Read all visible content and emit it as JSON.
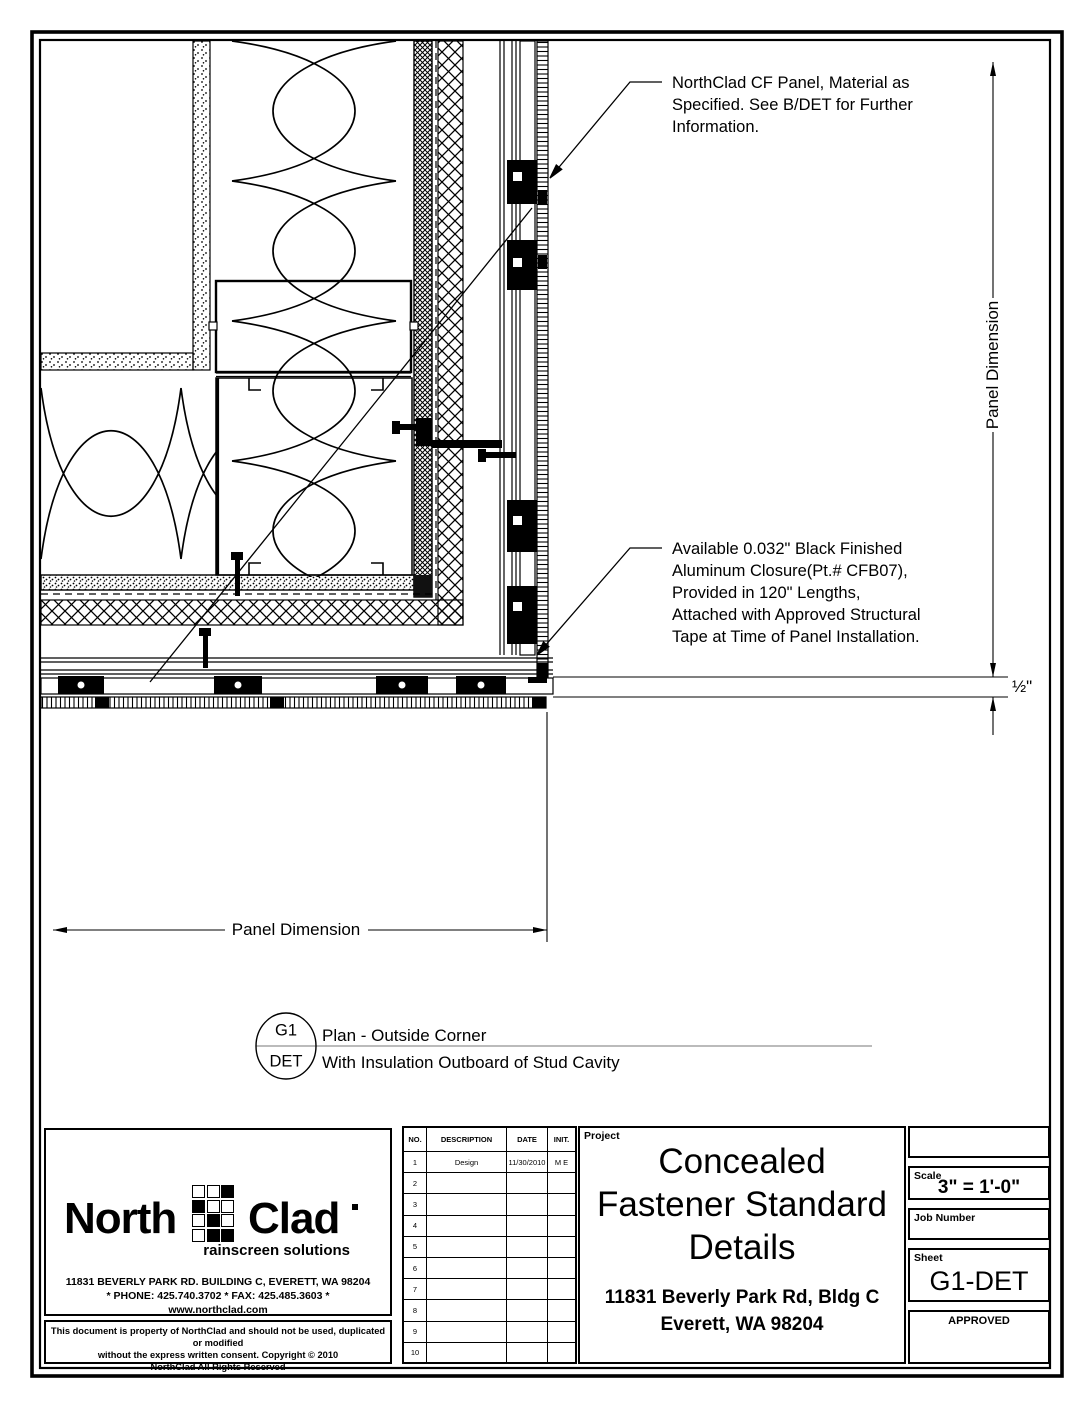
{
  "drawing": {
    "panel_note": {
      "line1": "NorthClad CF Panel, Material as",
      "line2": "Specified.  See B/DET for Further",
      "line3": "Information."
    },
    "closure_note": {
      "line1": "Available 0.032\" Black Finished",
      "line2": "Aluminum Closure(Pt.# CFB07),",
      "line3": "Provided in 120\" Lengths,",
      "line4": "Attached with Approved Structural",
      "line5": "Tape at Time of Panel Installation."
    },
    "dim_vertical": "Panel Dimension",
    "dim_horizontal": "Panel Dimension",
    "dim_half_inch": "½\""
  },
  "callout": {
    "top": "G1",
    "bottom": "DET",
    "title": "Plan - Outside Corner",
    "subtitle": "With Insulation Outboard of Stud Cavity"
  },
  "titleblock": {
    "logo": {
      "name_left": "North",
      "name_right": "Clad",
      "tagline": "rainscreen solutions",
      "address": "11831 BEVERLY PARK RD. BUILDING C, EVERETT, WA 98204",
      "phone_fax": "* PHONE: 425.740.3702 * FAX: 425.485.3603 *",
      "web": "www.northclad.com"
    },
    "copyright": {
      "line1": "This document is property of NorthClad and should not be used, duplicated or modified",
      "line2": "without the express written consent.  Copyright © 2010",
      "line3": "NorthClad All Rights Reserved"
    },
    "revisions": {
      "headers": [
        "NO.",
        "DESCRIPTION",
        "DATE",
        "INIT."
      ],
      "rows": [
        {
          "no": "1",
          "description": "Design",
          "date": "11/30/2010",
          "init": "M E"
        },
        {
          "no": "2",
          "description": "",
          "date": "",
          "init": ""
        },
        {
          "no": "3",
          "description": "",
          "date": "",
          "init": ""
        },
        {
          "no": "4",
          "description": "",
          "date": "",
          "init": ""
        },
        {
          "no": "5",
          "description": "",
          "date": "",
          "init": ""
        },
        {
          "no": "6",
          "description": "",
          "date": "",
          "init": ""
        },
        {
          "no": "7",
          "description": "",
          "date": "",
          "init": ""
        },
        {
          "no": "8",
          "description": "",
          "date": "",
          "init": ""
        },
        {
          "no": "9",
          "description": "",
          "date": "",
          "init": ""
        },
        {
          "no": "10",
          "description": "",
          "date": "",
          "init": ""
        }
      ]
    },
    "project": {
      "label": "Project",
      "title_line1": "Concealed",
      "title_line2": "Fastener Standard",
      "title_line3": "Details",
      "address_line1": "11831 Beverly Park Rd, Bldg C",
      "address_line2": "Everett, WA 98204"
    },
    "scale": {
      "label": "Scale",
      "value": "3\" = 1'-0\""
    },
    "job": {
      "label": "Job Number",
      "value": ""
    },
    "sheet": {
      "label": "Sheet",
      "value": "G1-DET"
    },
    "approved": {
      "label": "APPROVED"
    }
  }
}
